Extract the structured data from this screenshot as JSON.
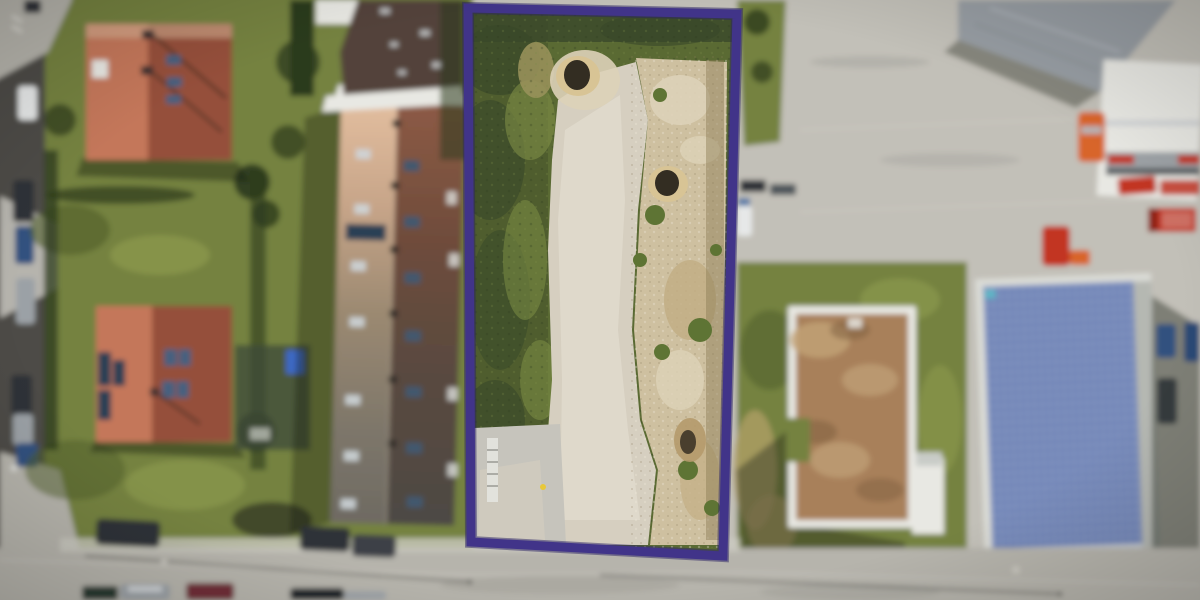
{
  "scene": {
    "type": "aerial-drone-photo",
    "subject": "Vacant development plot outlined with a purple boundary, between residential houses with red roofs on the left and a commercial solar-roof building on the right, streets with parked cars at the left and bottom edges",
    "plot": {
      "boundary_points": "468,8 737,14 723,556 471,542",
      "border_width": 9
    }
  },
  "colors": {
    "plot-border": "#413489",
    "plot-border-glow": "#2b2363",
    "grass-base": "#75823f",
    "grass-light": "#94a251",
    "grass-dark": "#4f5e2c",
    "hedge": "#2c3a1e",
    "plot-grass": "#5a6a33",
    "plot-grass-dark": "#39482a",
    "dirt-path": "#d6cfc0",
    "dirt-sand": "#cec0a0",
    "dirt-mound": "#ddd2b8",
    "hole": "#332d22",
    "hole-rim": "#d8c495",
    "concrete": "#c6c4bc",
    "road-dark": "#4d4c47",
    "road-light": "#b6b4ac",
    "pavement": "#c2c0b8",
    "sidewalk": "#cbc9c1",
    "roof-red-light": "#c4775a",
    "roof-red-dark": "#95503a",
    "roof-tan": "#dfb99c",
    "roof-dark-brown": "#52433a",
    "white-building": "#e8e8e3",
    "industrial-roof": "#979da3",
    "moss-roof": "#a8805a",
    "moss-roof-light": "#c2a277",
    "solar-blue": "#6d82b5",
    "solar-grid": "#b9c3dc",
    "solar-frame": "#dadbd6",
    "shadow": "rgba(25,30,20,0.42)",
    "car-red": "#c23524",
    "car-orange": "#d8652b",
    "car-blue": "#33517f",
    "car-dark": "#2e3338",
    "car-silver": "#9ba1a6",
    "car-white": "#e6e8e8",
    "car-darkred": "#702f38",
    "skylight-blue": "#47617f",
    "solar-panel-dark": "#2c3f54",
    "yellow-marker": "#e8c83a"
  }
}
